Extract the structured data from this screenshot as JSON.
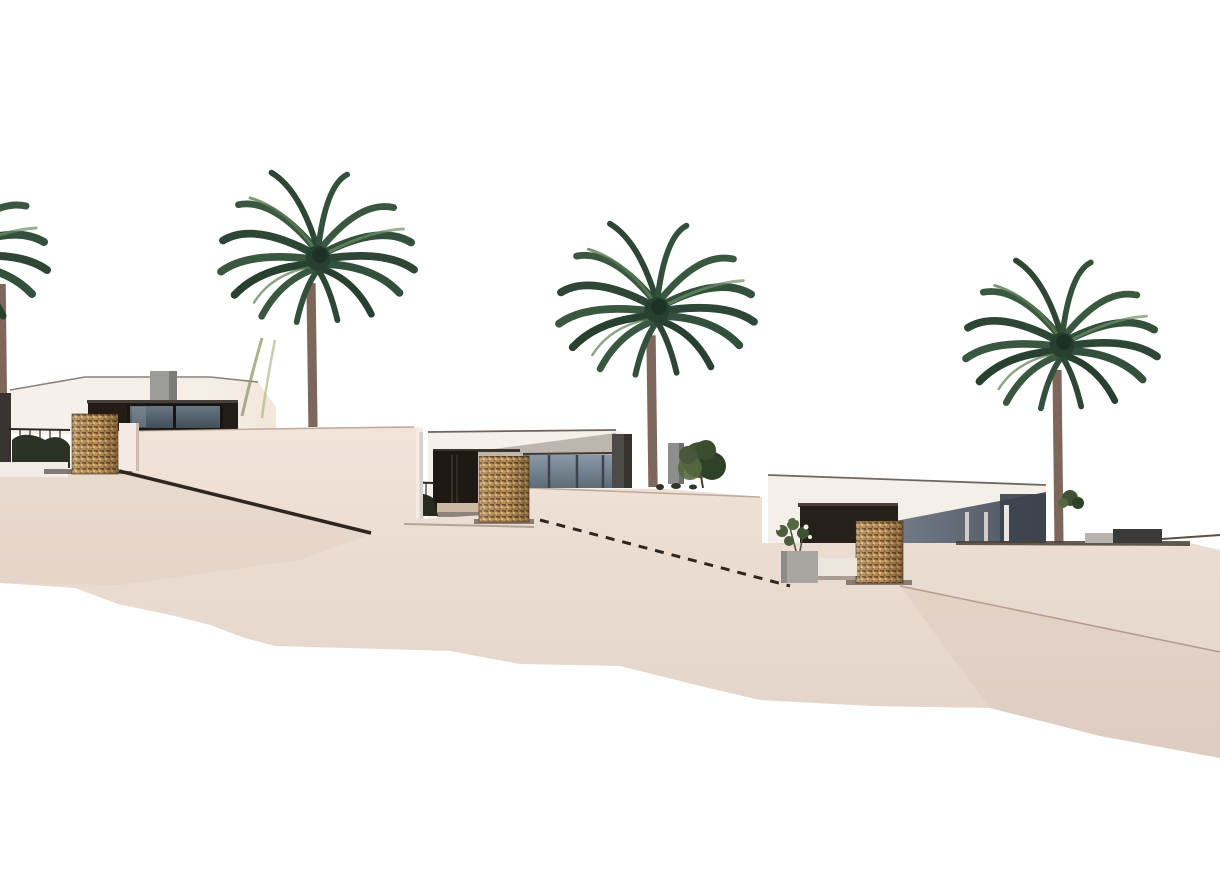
{
  "scene": {
    "kind": "architectural-render",
    "background": "#ffffff",
    "villas": [
      {
        "name": "villa-1",
        "description": "white flat-roof villa, upper-left terrace, dark glazed porch, roof chimney block"
      },
      {
        "name": "villa-2",
        "description": "white flat-roof villa, middle terrace, dark porch and blue-gray glazing"
      },
      {
        "name": "villa-3",
        "description": "white flat-roof villa, lower-right terrace, shaded gray facade and glass doors"
      }
    ],
    "palms": [
      {
        "name": "palm-tree-left-edge",
        "cx": -52,
        "cy": 258,
        "scale": 1.0,
        "trunk_x": 1,
        "trunk_base_y": 462
      },
      {
        "name": "palm-tree-1",
        "cx": 318,
        "cy": 258,
        "scale": 0.97,
        "trunk_x": 311,
        "trunk_base_y": 427
      },
      {
        "name": "palm-tree-2",
        "cx": 657,
        "cy": 310,
        "scale": 0.98,
        "trunk_x": 651,
        "trunk_base_y": 487
      },
      {
        "name": "palm-tree-3",
        "cx": 1062,
        "cy": 345,
        "scale": 0.96,
        "trunk_x": 1057,
        "trunk_base_y": 543
      }
    ],
    "handrails": [
      {
        "name": "terrace-handrail-1",
        "x1": 119,
        "y1": 471,
        "x2": 371,
        "y2": 533,
        "style": "solid",
        "width": 3.5
      },
      {
        "name": "terrace-handrail-2",
        "x1": 540,
        "y1": 520,
        "x2": 790,
        "y2": 586,
        "style": "dashed",
        "width": 3
      }
    ],
    "gabion_pillars": 3,
    "low_walls_right": 2
  },
  "palette": {
    "sky": "#ffffff",
    "sand-top": "#f2e4da",
    "sand-mid": "#ebdcd1",
    "sand-low": "#e2d3c9",
    "villa-white": "#f5f0ea",
    "villa-warm": "#f3e6da",
    "recess-dark": "#241c16",
    "glass-light": "#7e8d9b",
    "glass-dark": "#46525c",
    "gray-slab": "#4e4a47",
    "villa3-gray-light": "#78808e",
    "villa3-gray-dark": "#4a515c",
    "villa3-slab": "#3d434d",
    "chimney-gray": "#9c9c9a",
    "gabion-base": "#b68c57",
    "gabion-dark": "#6f4e28",
    "gabion-light": "#e0bd82",
    "rail-dark": "#2e2620",
    "palm-dark": "#2d4636",
    "palm-mid": "#3a573f",
    "palm-mid2": "#33503c",
    "palm-deep": "#27402f",
    "palm-light": "#5d7a52",
    "palm-light2": "#6d8f68",
    "trunk": "#7d675a",
    "tree-green": "#3f5233",
    "tree-green-dark": "#2f4127",
    "tree-green-light": "#55683f",
    "planter-gray": "#a9a5a1",
    "flower-white": "#f2f2ee",
    "wall-dark": "#3a3a3a",
    "wall-light": "#b9b4ae",
    "ground-line": "#4a3f36"
  }
}
